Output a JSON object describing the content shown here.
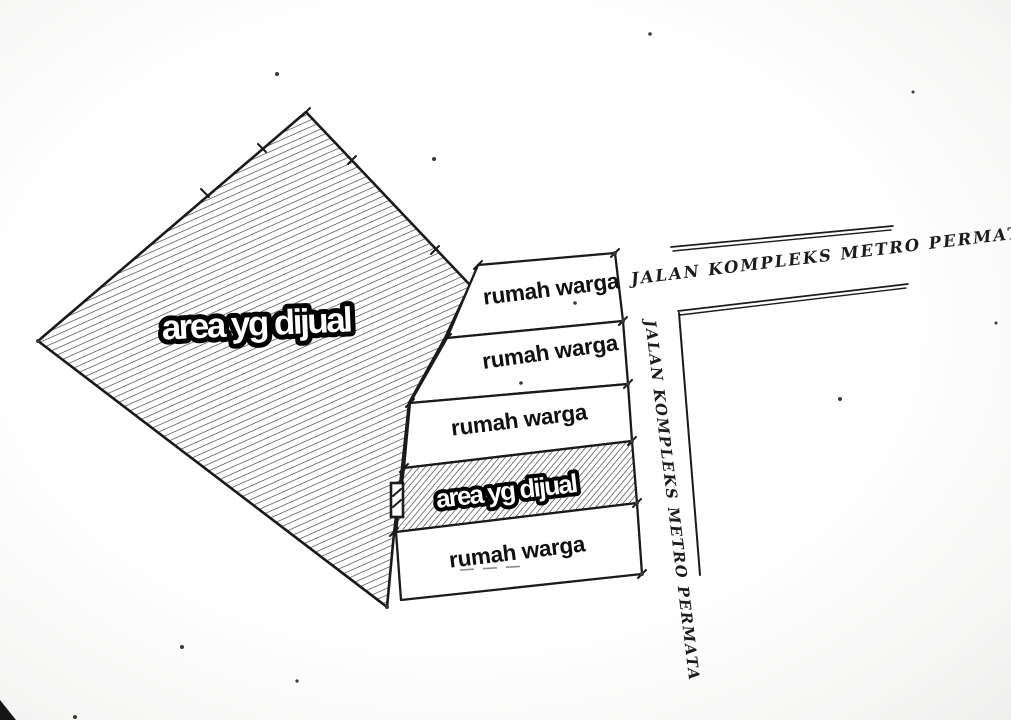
{
  "sketch": {
    "large_area_label": "area yg dijual",
    "strip_area_label": "area yg dijual",
    "house_plots": [
      "rumah warga",
      "rumah warga",
      "rumah warga",
      "rumah warga"
    ],
    "road_top_label": "JALAN KOMPLEKS METRO PERMATA",
    "road_side_label": "JALAN KOMPLEKS METRO PERMATA"
  },
  "colors": {
    "ink": "#1a1a1a",
    "paper": "#ffffff",
    "hatch_large": "#424242",
    "hatch_strip": "#333333",
    "caption_fill": "#ffffff",
    "caption_outline": "#000000"
  }
}
